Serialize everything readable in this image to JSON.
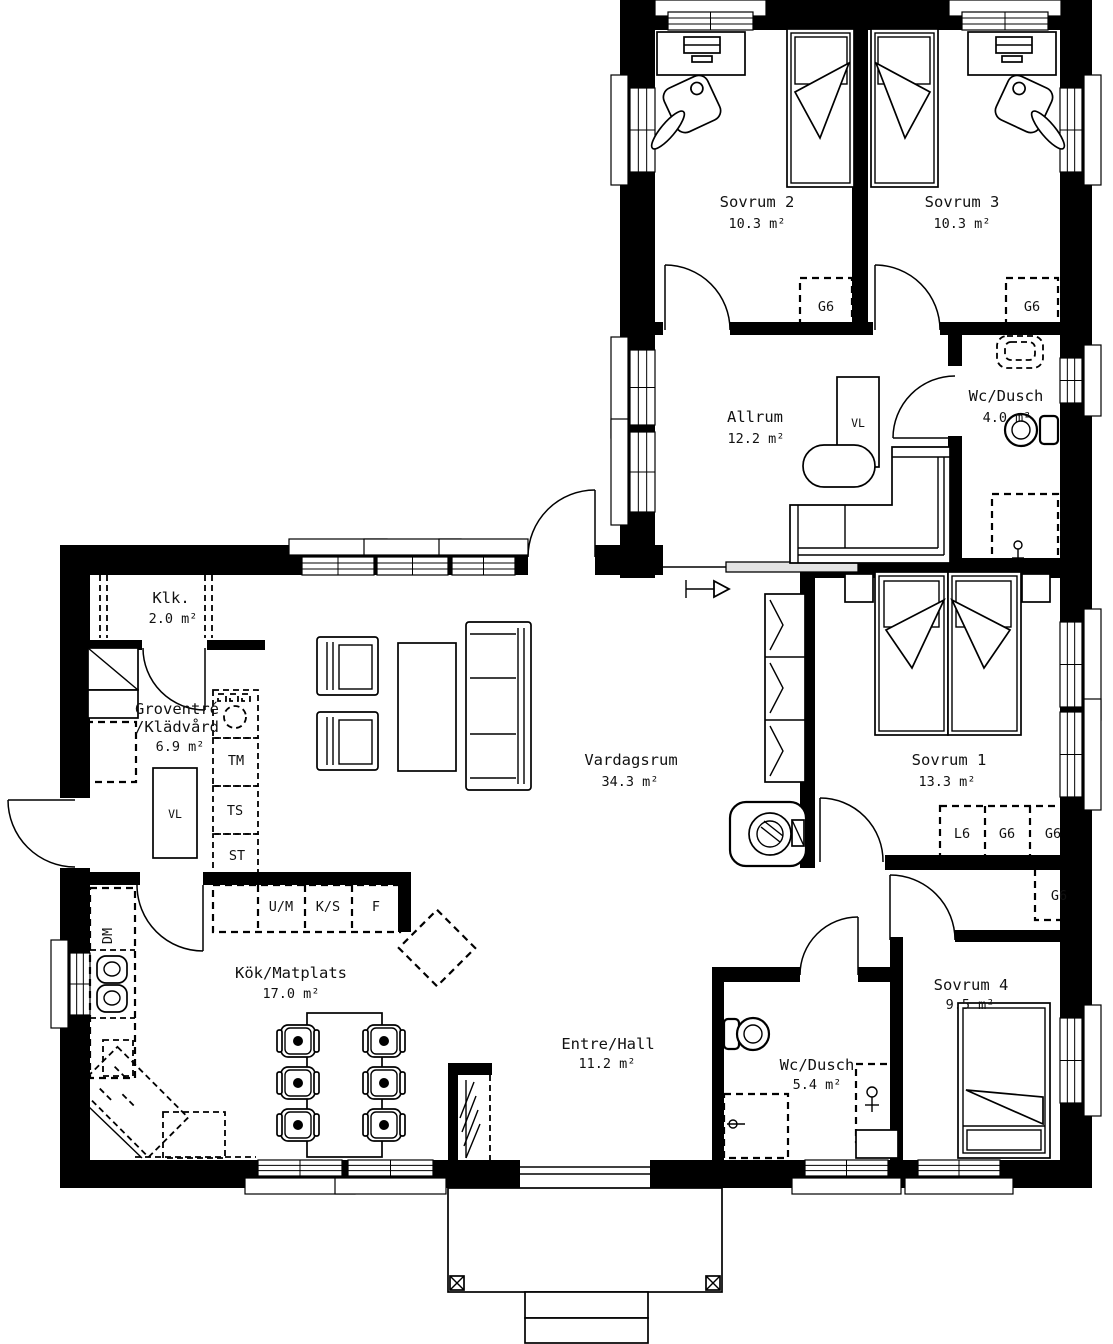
{
  "rooms": {
    "sovrum2": {
      "name": "Sovrum 2",
      "area": "10.3 m²"
    },
    "sovrum3": {
      "name": "Sovrum 3",
      "area": "10.3 m²"
    },
    "allrum": {
      "name": "Allrum",
      "area": "12.2 m²"
    },
    "wc_dusch_ovre": {
      "name": "Wc/Dusch",
      "area": "4.0 m²"
    },
    "klk": {
      "name": "Klk.",
      "area": "2.0 m²"
    },
    "groventre": {
      "name_line1": "Groventré",
      "name_line2": "/Klädvård",
      "area": "6.9 m²"
    },
    "vardagsrum": {
      "name": "Vardagsrum",
      "area": "34.3 m²"
    },
    "sovrum1": {
      "name": "Sovrum 1",
      "area": "13.3 m²"
    },
    "kok": {
      "name": "Kök/Matplats",
      "area": "17.0 m²"
    },
    "entre": {
      "name": "Entre/Hall",
      "area": "11.2 m²"
    },
    "wc_dusch_nedre": {
      "name": "Wc/Dusch",
      "area": "5.4 m²"
    },
    "sovrum4": {
      "name": "Sovrum 4",
      "area": "9.5 m²"
    }
  },
  "fixture_labels": {
    "g6": "G6",
    "l6": "L6",
    "vl": "VL",
    "tm": "TM",
    "ts": "TS",
    "st": "ST",
    "um": "U/M",
    "ks": "K/S",
    "f": "F",
    "dm": "DM"
  },
  "colors": {
    "wall": "#000000",
    "background": "#ffffff",
    "sliding_panel": "#e3e3e3"
  }
}
